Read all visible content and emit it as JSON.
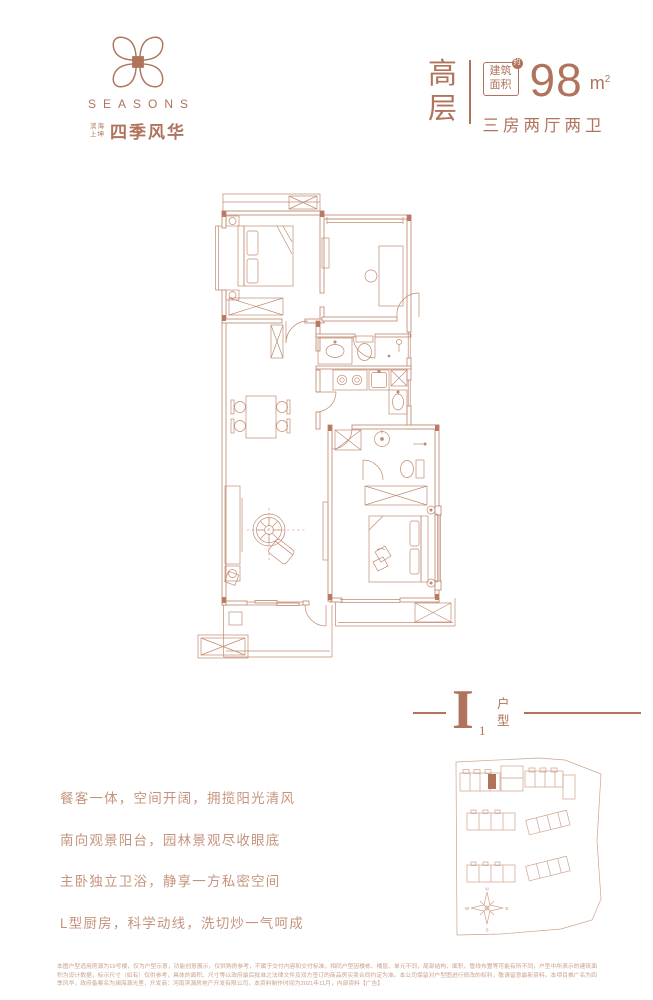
{
  "brand": {
    "wordmark": "SEASONS",
    "sub_small_top": "滨海",
    "sub_small_bottom": "上坤",
    "cn_name": "四季风华"
  },
  "spec": {
    "tier_char_1": "高",
    "tier_char_2": "层",
    "area_badge_top": "建筑",
    "area_badge_bottom": "面积",
    "area_badge_approx": "约",
    "area_value": "98",
    "area_unit": "m",
    "area_unit_sup": "2",
    "layout_text": "三房两厅两卫"
  },
  "unit": {
    "letter": "I",
    "sub": "1",
    "label_top": "户",
    "label_bottom": "型"
  },
  "features": [
    "餐客一体，空间开阔，拥揽阳光清风",
    "南向观景阳台，园林景观尽收眼底",
    "主卧独立卫浴，静享一方私密空间",
    "L型厨房，科学动线，洗切炒一气呵成"
  ],
  "siteplan": {
    "compass": {
      "n": "N",
      "e": "E",
      "s": "S",
      "w": "W"
    }
  },
  "disclaimer": "本图户型适用房源为19号楼，仅为户型示意，功能创意展示，仅供购房参考，不属于交付内容和交付标准，相同户型因楼栋、楼层、单元不同，局部结构、面积、管线布置等可能有所不同，户型中所表示的建筑面积为设计数据，标示尺寸（如有）仅供参考，具体的面积、尺寸等以政府最后批准之法律文件及双方签订的商品房买卖合同约定为准。本公司保留对户型图进行修改的权利，敬请留意最新资料。本项目推广名为四季风华，政府备案名为澜海源光里，开发商：河南滨源房地产开发有限公司，本资料制作时间为2021年11月，内部资料【广告】",
  "colors": {
    "accent": "#b0735c",
    "plan_line": "#c18a71",
    "feature_text": "#c6947e"
  }
}
